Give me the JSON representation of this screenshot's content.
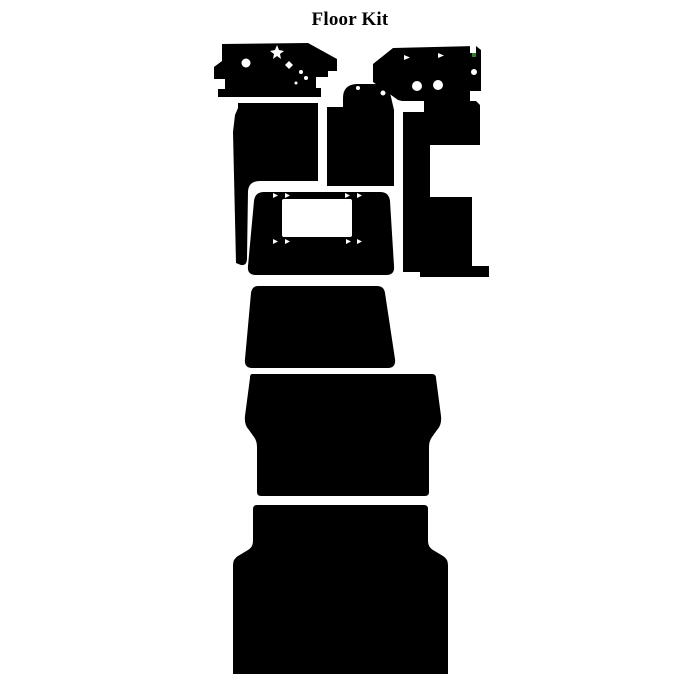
{
  "page": {
    "title": "Floor Kit",
    "background_color": "#ffffff"
  },
  "illustration": {
    "description": "die-cut floor kit pieces shown as black silhouettes",
    "ink_color": "#000000",
    "hole_color": "#ffffff",
    "artifact_color": "#2e7d2e",
    "canvas": {
      "width": 700,
      "height": 700
    },
    "pieces": [
      {
        "name": "front-left-floor-panel",
        "path": "M222,44 L308,43 L337,59 L337,71 L328,71 L328,77 L316,77 L316,88 L321,88 L321,97 L218,97 L218,89 L225,89 L225,79 L214,79 L214,67 L222,61 Z",
        "holes": [
          {
            "type": "poly",
            "points": "277,45 279,50 284,51 280,54 281,59 277,56 273,59 274,54 270,51 275,50"
          },
          {
            "type": "circle",
            "cx": 246,
            "cy": 63,
            "r": 4.5
          },
          {
            "type": "poly",
            "points": "289,61 293,65 289,69 285,65"
          },
          {
            "type": "circle",
            "cx": 301,
            "cy": 72,
            "r": 2
          },
          {
            "type": "circle",
            "cx": 306,
            "cy": 78,
            "r": 2
          },
          {
            "type": "circle",
            "cx": 296,
            "cy": 83,
            "r": 1.5
          }
        ]
      },
      {
        "name": "front-right-floor-panel",
        "path": "M393,48 L476,46 L481,50 L481,91 L470,91 L470,101 L402,101 L398,100 L373,82 L373,64 Z",
        "holes": [
          {
            "type": "poly",
            "points": "404,55 410,57.5 404,60"
          },
          {
            "type": "poly",
            "points": "438,53 444,55.5 438,58"
          },
          {
            "type": "rect",
            "x": 470,
            "y": 46,
            "w": 6,
            "h": 7
          },
          {
            "type": "rect",
            "x": 472,
            "y": 53,
            "w": 4,
            "h": 4,
            "fill": "artifact"
          },
          {
            "type": "circle",
            "cx": 474,
            "cy": 72,
            "r": 3
          },
          {
            "type": "circle",
            "cx": 417,
            "cy": 86,
            "r": 5
          },
          {
            "type": "circle",
            "cx": 438,
            "cy": 85,
            "r": 5
          },
          {
            "type": "poly",
            "points": "471,92 477,94.5 471,97"
          }
        ]
      },
      {
        "name": "left-floor-panel",
        "path": "M238,103 L318,103 L318,181 L260,181 Q249,181 248,191 L247,258 Q247,266 241,265 L236,263 L233,132 L235,115 L238,108 Z",
        "holes": []
      },
      {
        "name": "center-tunnel-panel",
        "path": "M343,98 Q343,85 356,84 L374,84 Q388,84 391,97 L394,110 L394,186 L327,186 L327,107 L343,107 Z",
        "holes": [
          {
            "type": "circle",
            "cx": 358,
            "cy": 88,
            "r": 2
          },
          {
            "type": "circle",
            "cx": 383,
            "cy": 93,
            "r": 2.5
          }
        ]
      },
      {
        "name": "right-floor-panel",
        "path": "M403,112 L424,112 L424,101 L476,101 L480,105 L480,145 L430,145 L430,197 L472,197 L472,266 L489,266 L489,277 L420,277 L420,272 L403,272 Z",
        "holes": []
      },
      {
        "name": "engine-cover-panel",
        "path": "M264,192 L380,192 Q389,192 390,201 L394,266 Q395,275 386,275 L256,275 Q247,275 248,266 L254,201 Q255,192 264,192 Z",
        "holes": [
          {
            "type": "rect",
            "x": 282,
            "y": 199,
            "w": 70,
            "h": 38,
            "rx": 2
          },
          {
            "type": "poly",
            "points": "273,193 278,195.5 273,198"
          },
          {
            "type": "poly",
            "points": "285,193 290,195.5 285,198"
          },
          {
            "type": "poly",
            "points": "345,193 350,195.5 345,198"
          },
          {
            "type": "poly",
            "points": "357,193 362,195.5 357,198"
          },
          {
            "type": "poly",
            "points": "273,239 278,241.5 273,244"
          },
          {
            "type": "poly",
            "points": "285,239 290,241.5 285,244"
          },
          {
            "type": "poly",
            "points": "346,239 351,241.5 346,244"
          },
          {
            "type": "poly",
            "points": "357,239 362,241.5 357,244"
          }
        ]
      },
      {
        "name": "mid-floor-panel",
        "path": "M258,286 L377,286 Q384,286 385,293 L395,359 Q396,368 388,368 L252,368 Q244,368 245,359 L251,293 Q252,286 258,286 Z",
        "holes": []
      },
      {
        "name": "cab-floor-panel",
        "path": "M252,374 L432,374 Q436,374 436,378 L441,416 Q442,425 437,430 L432,437 Q429,441 429,447 L429,492 Q429,496 425,496 L261,496 Q257,496 257,492 L257,447 Q257,441 254,437 L249,430 Q244,425 245,416 L250,378 Q250,374 252,374 Z",
        "holes": []
      },
      {
        "name": "rear-floor-panel",
        "path": "M257,505 L424,505 Q428,505 428,509 L428,541 Q428,547 433,550 L443,556 Q448,559 448,565 L448,674 L233,674 L233,565 Q233,559 238,556 L248,550 Q253,547 253,541 L253,509 Q253,505 257,505 Z",
        "holes": []
      }
    ]
  }
}
